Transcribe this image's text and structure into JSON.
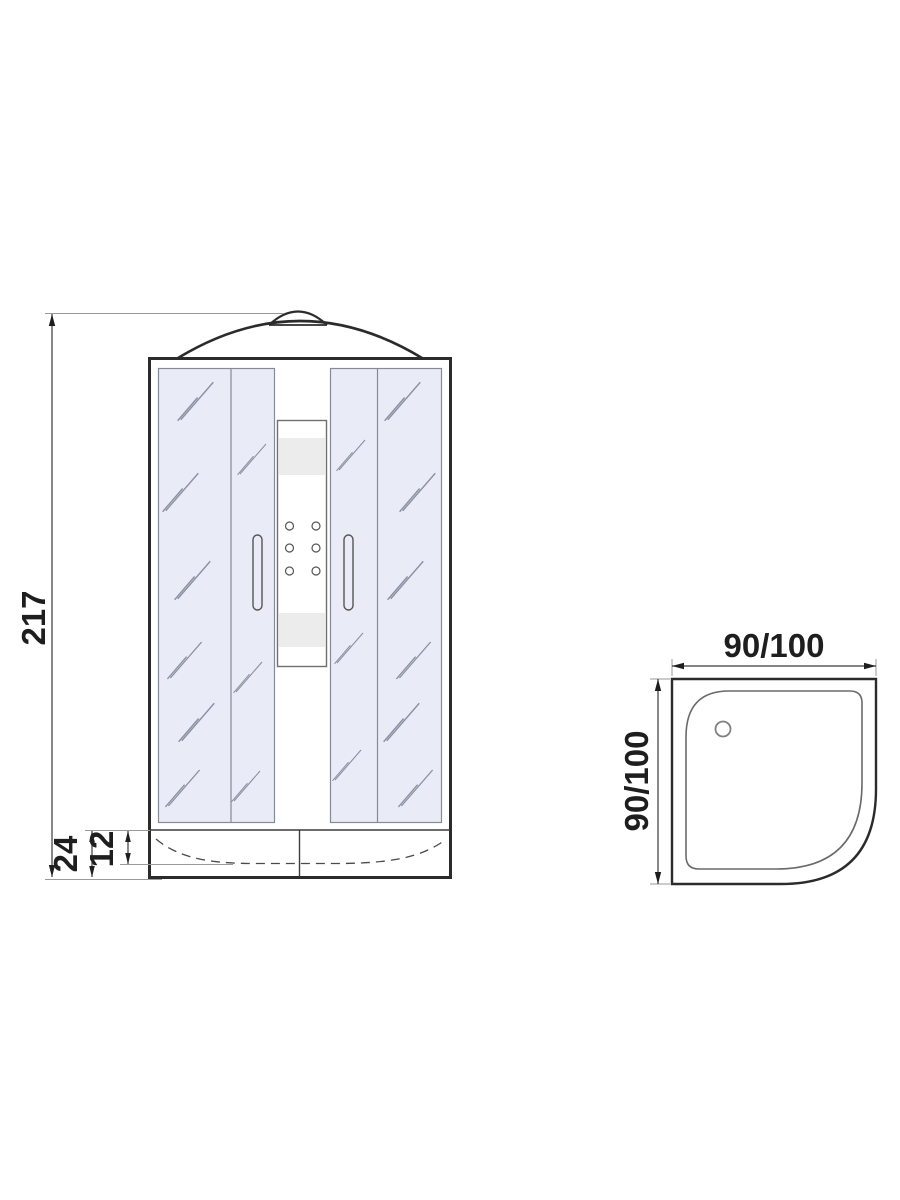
{
  "drawing": {
    "front_view": {
      "dimensions": {
        "overall_height": "217",
        "tray_height": "24",
        "tray_inner_depth": "12"
      }
    },
    "top_view": {
      "dimensions": {
        "width": "90/100",
        "depth": "90/100"
      }
    },
    "colors": {
      "background": "#ffffff",
      "outline_dark": "#2b2b2b",
      "detail_gray": "#6f6f6f",
      "glass_fill": "#e9ecf7",
      "hatch": "#8a90a2",
      "panel_band": "#ececec",
      "dimension_text": "#1e1e1e"
    }
  }
}
